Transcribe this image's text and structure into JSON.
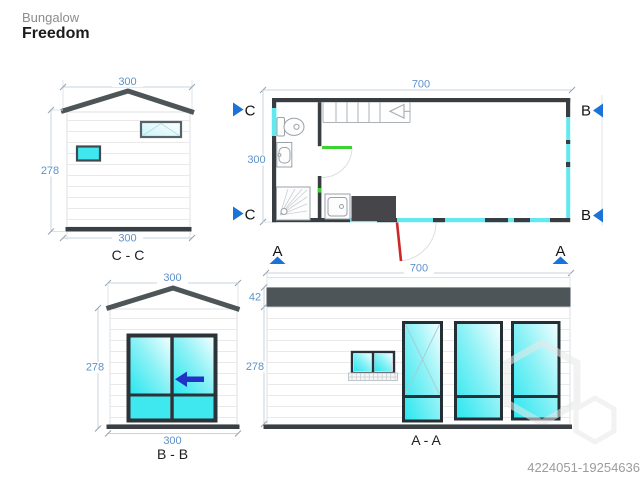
{
  "header": {
    "brand": "Bungalow",
    "model": "Freedom"
  },
  "footer": {
    "code": "4224051-19254636"
  },
  "colors": {
    "dim_text_blue": "#5C92CB",
    "marker_blue": "#1B72D8",
    "arrow_blue": "#2033C6",
    "door_green": "#3BD331",
    "door_red": "#CE2727",
    "glass_cyan": "#3FE7EE",
    "glazing_cyan": "#62E9F0",
    "structure_gray": "#4E5559"
  },
  "plan": {
    "dim_top": "700",
    "dim_left": "300",
    "marker_c": "C",
    "marker_b": "B",
    "marker_a": "A"
  },
  "view_cc": {
    "label": "C - C",
    "dim_top": "300",
    "dim_left": "278",
    "dim_bottom": "300"
  },
  "view_bb": {
    "label": "B - B",
    "dim_top": "300",
    "dim_left": "278",
    "dim_bottom": "300"
  },
  "view_aa": {
    "label": "A - A",
    "dim_top": "700",
    "dim_fascia": "42",
    "dim_left": "278"
  }
}
